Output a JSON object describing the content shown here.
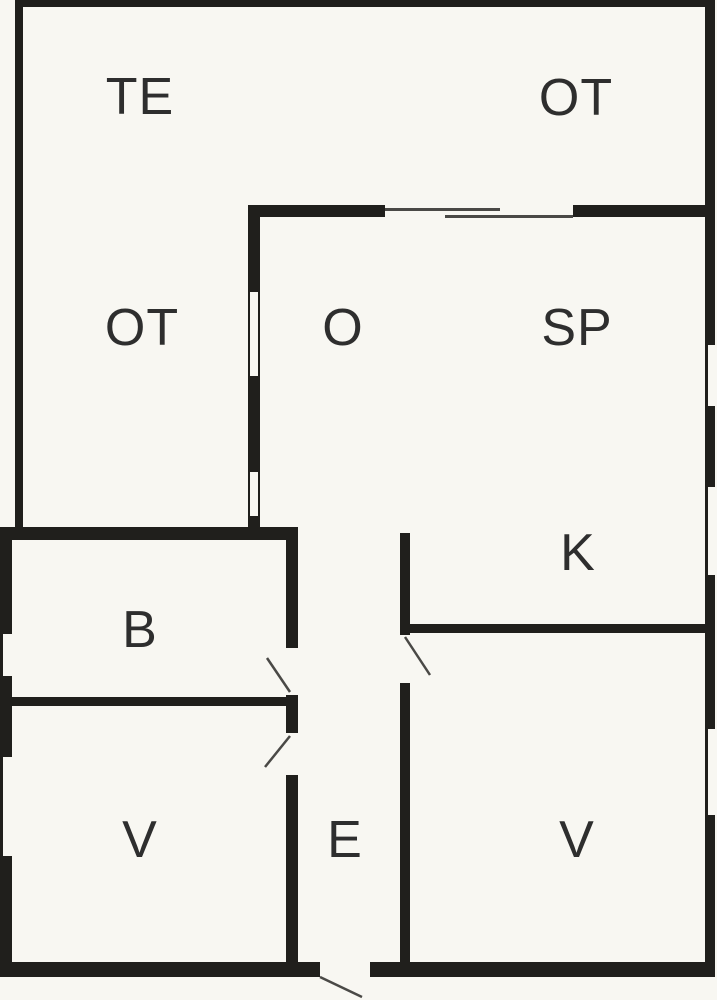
{
  "colors": {
    "background": "#f8f7f2",
    "wall": "#201f1c",
    "label": "#2e2e2e",
    "door_line": "#4a4946"
  },
  "rooms": [
    {
      "id": "te",
      "label": "TE"
    },
    {
      "id": "ot-top",
      "label": "OT"
    },
    {
      "id": "ot-left",
      "label": "OT"
    },
    {
      "id": "o",
      "label": "O"
    },
    {
      "id": "sp",
      "label": "SP"
    },
    {
      "id": "b",
      "label": "B"
    },
    {
      "id": "k",
      "label": "K"
    },
    {
      "id": "v-left",
      "label": "V"
    },
    {
      "id": "e",
      "label": "E"
    },
    {
      "id": "v-right",
      "label": "V"
    }
  ]
}
